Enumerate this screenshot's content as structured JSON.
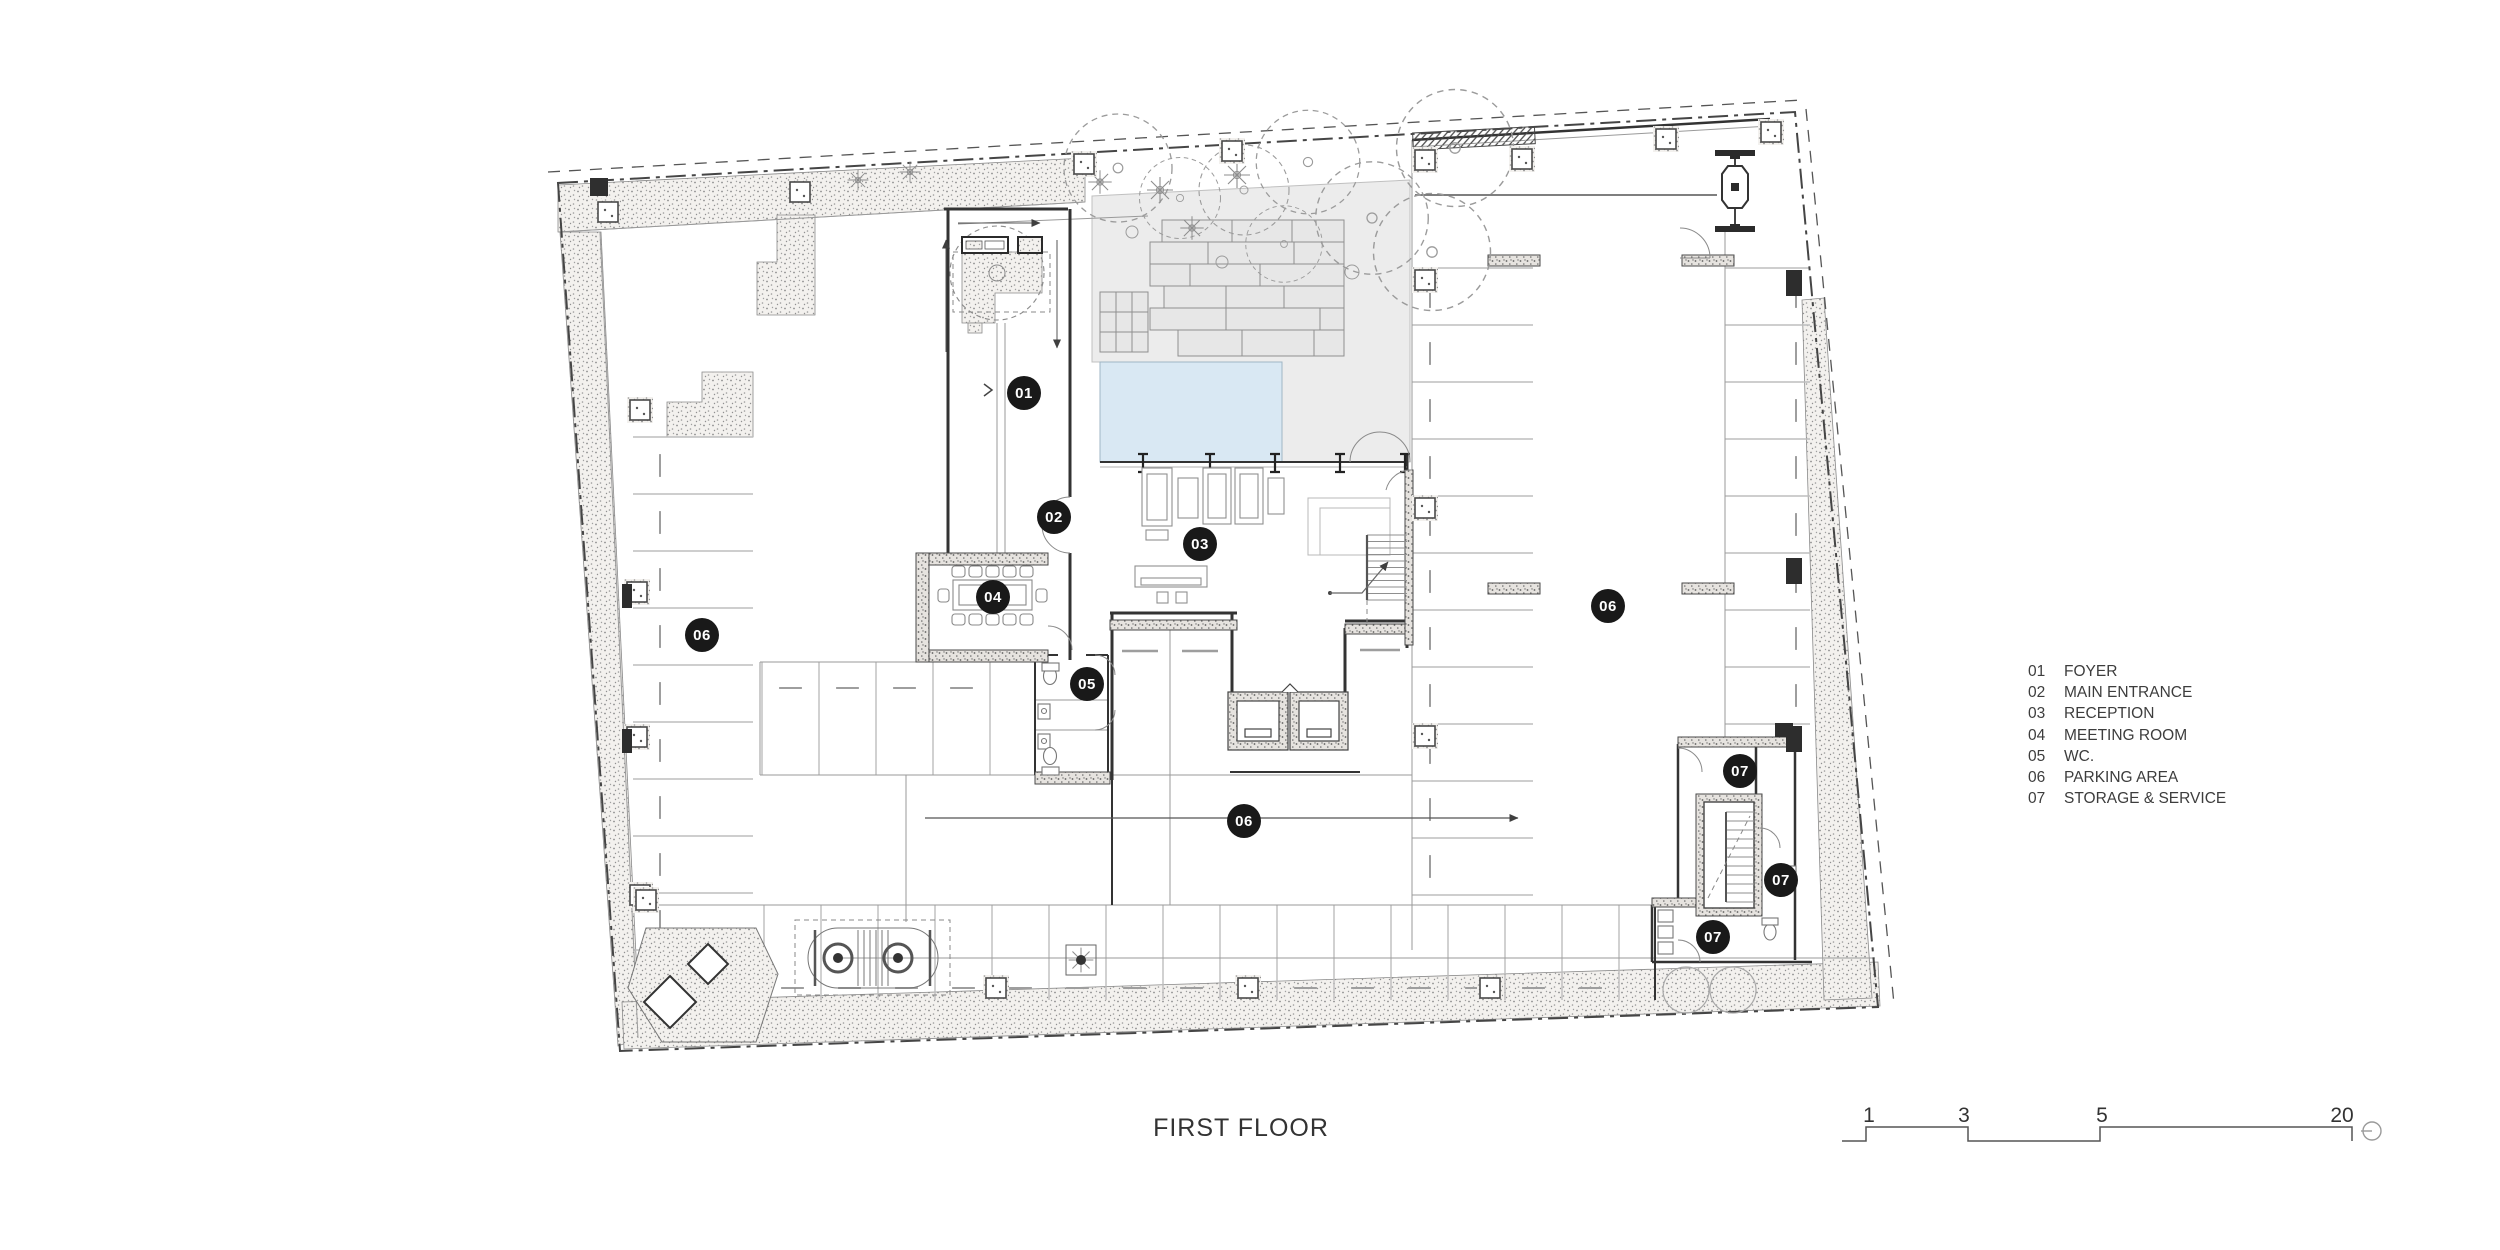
{
  "title": "FIRST FLOOR",
  "legend": {
    "items": [
      {
        "num": "01",
        "label": "FOYER"
      },
      {
        "num": "02",
        "label": "MAIN ENTRANCE"
      },
      {
        "num": "03",
        "label": "RECEPTION"
      },
      {
        "num": "04",
        "label": "MEETING ROOM"
      },
      {
        "num": "05",
        "label": "WC."
      },
      {
        "num": "06",
        "label": "PARKING AREA"
      },
      {
        "num": "07",
        "label": "STORAGE & SERVICE"
      }
    ]
  },
  "badges": [
    {
      "label": "01",
      "room": "FOYER",
      "x": 1024,
      "y": 393
    },
    {
      "label": "02",
      "room": "MAIN ENTRANCE",
      "x": 1054,
      "y": 517
    },
    {
      "label": "03",
      "room": "RECEPTION",
      "x": 1200,
      "y": 544
    },
    {
      "label": "04",
      "room": "MEETING ROOM",
      "x": 993,
      "y": 597
    },
    {
      "label": "05",
      "room": "WC.",
      "x": 1087,
      "y": 684
    },
    {
      "label": "06",
      "room": "PARKING AREA",
      "x": 702,
      "y": 635
    },
    {
      "label": "06",
      "room": "PARKING AREA",
      "x": 1608,
      "y": 606
    },
    {
      "label": "06",
      "room": "PARKING AREA",
      "x": 1244,
      "y": 821
    },
    {
      "label": "07",
      "room": "STORAGE & SERVICE",
      "x": 1740,
      "y": 771
    },
    {
      "label": "07",
      "room": "STORAGE & SERVICE",
      "x": 1781,
      "y": 880
    },
    {
      "label": "07",
      "room": "STORAGE & SERVICE",
      "x": 1713,
      "y": 937
    }
  ],
  "scalebar": {
    "labels": [
      "1",
      "3",
      "5",
      "20"
    ]
  },
  "colors": {
    "pool": "#d9e8f3",
    "badge": "#191919",
    "line": "#3a3a3a",
    "stipple": "#8e8e8e"
  }
}
